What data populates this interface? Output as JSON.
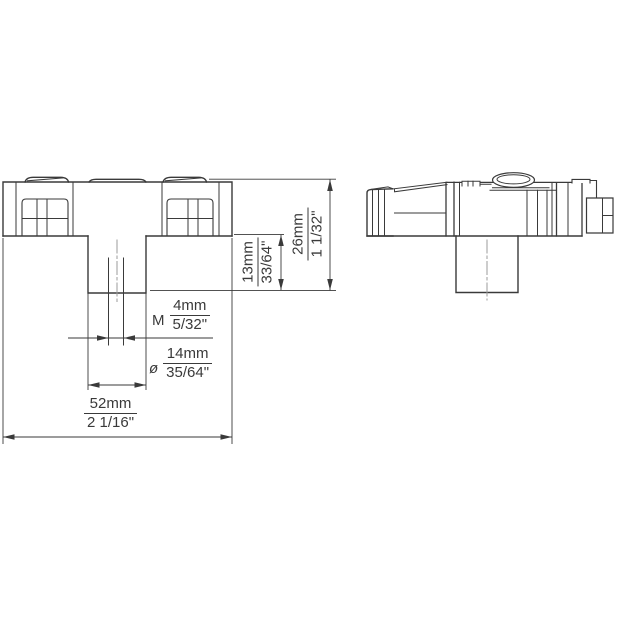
{
  "drawing": {
    "title": "knob-two-view-dimensioned-drawing",
    "line_color": "#3a3a3a",
    "centerline_color": "#9b9b9b",
    "background_color": "#ffffff"
  },
  "dimensions": {
    "total_width": {
      "mm": "52mm",
      "inch": "2 1/16\""
    },
    "total_height": {
      "mm": "26mm",
      "inch": "1 1/32\""
    },
    "hub_height": {
      "mm": "13mm",
      "inch": "33/64\""
    },
    "thread": {
      "prefix": "M",
      "mm": "4mm",
      "inch": "5/32\""
    },
    "hub_diameter": {
      "prefix": "ø",
      "mm": "14mm",
      "inch": "35/64\""
    }
  }
}
